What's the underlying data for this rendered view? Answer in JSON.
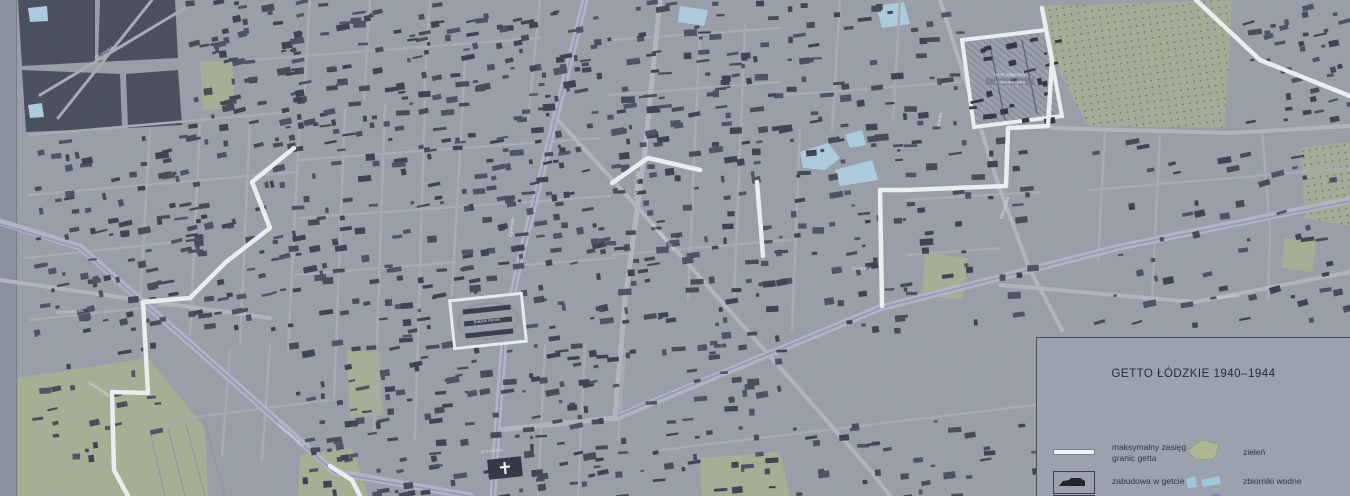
{
  "legend": {
    "title": "GETTO ŁÓDZKIE 1940–1944",
    "items": [
      {
        "swatch": "ghetto-boundary-line",
        "label": "maksymalny zasięg granic getta"
      },
      {
        "swatch": "building-in-ghetto",
        "label": "zabudowa w getcie"
      },
      {
        "swatch": "building-box-cutoff",
        "label": ""
      },
      {
        "swatch": "green-area",
        "label": "zieleń"
      },
      {
        "swatch": "water-body",
        "label": "zbiorniki wodne"
      },
      {
        "swatch": "railway-line",
        "label": "linie kolejowe"
      }
    ]
  },
  "map": {
    "colors": {
      "base": "#9aa0aa",
      "margin": "#8a919d",
      "building": [
        "#3a3f4d",
        "#434854",
        "#4b5060"
      ],
      "dark_block": "#474c5a",
      "road_minor": "#a8adb7",
      "road_major": "#b3b8c2",
      "boundary": "#f3f4f6",
      "green": "#a8b094",
      "cemetery_bg": "#a5ae96",
      "cemetery_dot": "#67755c",
      "water": "#aecfe2",
      "railway": "#998dc4",
      "hatch_line": "#6f7587",
      "label": "#e8eaf0",
      "field_line": "#8f95a0",
      "market_outline": "#eef0f3",
      "cross": "#f5f6f8"
    },
    "labels": [
      {
        "text": "Okopowa",
        "x": 105,
        "y": 54,
        "rot": -35,
        "size": 5
      },
      {
        "text": "Zgierska",
        "x": 513,
        "y": 228,
        "rot": -82,
        "size": 5
      },
      {
        "text": "Łagiewnicka",
        "x": 638,
        "y": 185,
        "rot": -84,
        "size": 5
      },
      {
        "text": "Franciszkańska",
        "x": 662,
        "y": 238,
        "rot": 48,
        "size": 4.6
      },
      {
        "text": "Dworska",
        "x": 862,
        "y": 270,
        "rot": -3,
        "size": 5
      },
      {
        "text": "Bracka",
        "x": 941,
        "y": 120,
        "rot": -80,
        "size": 4.6
      },
      {
        "text": "Marysińska",
        "x": 1006,
        "y": 208,
        "rot": -72,
        "size": 4.6
      },
      {
        "text": "Brzezińska",
        "x": 1228,
        "y": 298,
        "rot": -6,
        "size": 4.6
      },
      {
        "text": "Limanowskiego",
        "x": 290,
        "y": 436,
        "rot": 40,
        "size": 5
      },
      {
        "text": "Lutomierska",
        "x": 98,
        "y": 390,
        "rot": 34,
        "size": 4.8
      },
      {
        "text": "Wrześnieńska",
        "x": 70,
        "y": 313,
        "rot": -4,
        "size": 4.4
      },
      {
        "text": "Bałucki Rynek",
        "x": 487,
        "y": 322,
        "rot": -6,
        "size": 4.2
      },
      {
        "text": "pl. Kościelny",
        "x": 492,
        "y": 452,
        "rot": -4,
        "size": 4.0
      }
    ],
    "hatched_area": {
      "pts": "962,40 1046,30 1062,116 974,127",
      "label_line1": "teren wyłączony",
      "label_line2": "z obszaru getta",
      "lx": 1010,
      "ly": 76
    },
    "greens": [
      "18,378 148,358 205,428 208,496 18,496",
      "347,350 380,352 382,415 350,418",
      "300,455 352,448 368,496 298,496",
      "200,62 232,60 235,108 203,110",
      "925,253 968,258 962,300 922,295",
      "700,458 780,452 790,496 702,496",
      "1284,238 1316,242 1312,272 1282,268"
    ],
    "cemeteries": [
      "1042,6 1232,0 1225,128 1088,126 1054,62",
      "1300,148 1350,142 1350,226 1305,218"
    ],
    "waters": [
      "800,152 828,143 840,158 825,170 803,168",
      "835,170 872,160 878,180 840,186",
      "845,135 862,130 866,145 850,148",
      "876,6 904,2 910,24 882,28",
      "680,6 708,10 704,26 678,22",
      "28,8 47,6 48,21 30,22",
      "28,105 42,103 44,117 30,118"
    ],
    "dark_blocks": [
      "18,0 95,0 95,62 22,66",
      "100,0 175,0 178,58 98,62",
      "22,70 120,74 122,128 26,132",
      "126,74 178,70 182,125 128,128"
    ],
    "roads_major": [
      {
        "pts": "585,0 555,120 520,260 505,330 497,430 493,496",
        "w": 7
      },
      {
        "pts": "0,222 80,247 200,352 335,472 470,496",
        "w": 7
      },
      {
        "pts": "615,418 880,308 1120,247 1350,200",
        "w": 7
      },
      {
        "pts": "660,0 645,150 625,300 615,418",
        "w": 5
      },
      {
        "pts": "497,430 615,418",
        "w": 5
      },
      {
        "pts": "1000,285 1195,302 1350,272",
        "w": 4
      },
      {
        "pts": "556,118 640,210 720,300 800,390 870,470 890,496",
        "w": 4
      },
      {
        "pts": "940,0 975,110 1000,190 1030,270 1062,330",
        "w": 4
      },
      {
        "pts": "1052,128 1230,133 1350,126",
        "w": 4
      },
      {
        "pts": "0,280 140,300 270,318",
        "w": 4
      }
    ],
    "roads_minor": [
      {
        "pts": "58,118 152,0",
        "w": 3
      },
      {
        "pts": "40,95 185,8",
        "w": 3
      },
      {
        "pts": "150,130 140,300",
        "w": 2.5
      },
      {
        "pts": "200,125 190,335",
        "w": 2.5
      },
      {
        "pts": "250,120 240,345",
        "w": 2.5
      },
      {
        "pts": "300,115 288,350",
        "w": 2.5
      },
      {
        "pts": "345,110 334,400",
        "w": 2.5
      },
      {
        "pts": "385,105 374,430",
        "w": 2.5
      },
      {
        "pts": "425,100 415,440",
        "w": 2.5
      },
      {
        "pts": "465,60 452,295",
        "w": 2.5
      },
      {
        "pts": "540,0 528,120",
        "w": 2.5
      },
      {
        "pts": "430,0 424,95",
        "w": 2.5
      },
      {
        "pts": "370,0 364,100",
        "w": 2.5
      },
      {
        "pts": "310,0 304,98",
        "w": 2.5
      },
      {
        "pts": "700,30 688,300",
        "w": 2.5
      },
      {
        "pts": "745,25 734,300",
        "w": 2.5
      },
      {
        "pts": "800,130 792,330",
        "w": 2.5
      },
      {
        "pts": "840,0 832,130",
        "w": 2.5
      },
      {
        "pts": "900,0 893,120",
        "w": 2.5
      },
      {
        "pts": "1105,132 1098,260",
        "w": 2.5
      },
      {
        "pts": "1160,135 1152,300",
        "w": 2.5
      },
      {
        "pts": "1262,130 1270,230 1268,300",
        "w": 2.5
      },
      {
        "pts": "30,135 290,112",
        "w": 2.5
      },
      {
        "pts": "28,195 295,172",
        "w": 2.5
      },
      {
        "pts": "25,258 195,240",
        "w": 2.5
      },
      {
        "pts": "300,160 600,138",
        "w": 2.5
      },
      {
        "pts": "300,218 610,196",
        "w": 2.5
      },
      {
        "pts": "295,275 455,262",
        "w": 2.5
      },
      {
        "pts": "525,265 615,258",
        "w": 2.5
      },
      {
        "pts": "610,95 780,82",
        "w": 2.5
      },
      {
        "pts": "612,255 790,240",
        "w": 2.5
      },
      {
        "pts": "785,95 960,82",
        "w": 2.5
      },
      {
        "pts": "905,200 1040,192",
        "w": 2.5
      },
      {
        "pts": "908,255 1000,248",
        "w": 2.5
      },
      {
        "pts": "1090,190 1350,168",
        "w": 2.5
      },
      {
        "pts": "250,60 540,38",
        "w": 2.5
      },
      {
        "pts": "610,40 780,28",
        "w": 2.5
      },
      {
        "pts": "30,320 170,305",
        "w": 2.5
      },
      {
        "pts": "660,450 1035,405",
        "w": 2.5
      },
      {
        "pts": "545,345 538,496",
        "w": 2.5
      },
      {
        "pts": "585,345 578,496",
        "w": 2.5
      },
      {
        "pts": "625,350 618,440",
        "w": 2.5
      },
      {
        "pts": "230,350 222,455",
        "w": 2.5
      },
      {
        "pts": "270,345 262,460",
        "w": 2.5
      },
      {
        "pts": "170,420 330,400",
        "w": 2
      }
    ],
    "field_lines": [
      "150,432 165,496",
      "168,428 185,496",
      "186,424 205,496",
      "204,420 225,496"
    ],
    "railways": [
      "585,0 555,120 520,260 505,330 497,430 493,496",
      "0,224 80,248 200,352 335,473 470,496",
      "617,416 880,308 1120,247 1350,201"
    ],
    "boundary_segments": [
      "294,148 252,182 270,228 226,262 190,298 143,302 148,393 112,392 114,470 128,496",
      "330,466 352,480 360,496",
      "612,183 648,158 700,170",
      "757,182 763,256",
      "882,306 880,190 906,190 1006,186 1008,128 1048,126",
      "1048,126 1052,60 1042,8",
      "1196,0 1260,60 1350,96"
    ],
    "building_zones": [
      {
        "x": 185,
        "y": 0,
        "w": 115,
        "h": 130,
        "n": 60,
        "a": -10
      },
      {
        "x": 30,
        "y": 135,
        "w": 250,
        "h": 200,
        "n": 150,
        "a": -10
      },
      {
        "x": 285,
        "y": 0,
        "w": 315,
        "h": 150,
        "n": 160,
        "a": -8
      },
      {
        "x": 285,
        "y": 150,
        "w": 315,
        "h": 250,
        "n": 220,
        "a": -8
      },
      {
        "x": 300,
        "y": 400,
        "w": 300,
        "h": 96,
        "n": 90,
        "a": -8
      },
      {
        "x": 605,
        "y": 0,
        "w": 175,
        "h": 200,
        "n": 100,
        "a": -6
      },
      {
        "x": 605,
        "y": 200,
        "w": 175,
        "h": 210,
        "n": 90,
        "a": -6
      },
      {
        "x": 785,
        "y": 0,
        "w": 175,
        "h": 150,
        "n": 60,
        "a": -5
      },
      {
        "x": 785,
        "y": 150,
        "w": 120,
        "h": 180,
        "n": 40,
        "a": -5
      },
      {
        "x": 905,
        "y": 130,
        "w": 130,
        "h": 190,
        "n": 35,
        "a": -5
      },
      {
        "x": 1085,
        "y": 140,
        "w": 265,
        "h": 185,
        "n": 55,
        "a": -12
      },
      {
        "x": 1235,
        "y": 0,
        "w": 115,
        "h": 125,
        "n": 38,
        "a": -12
      },
      {
        "x": 605,
        "y": 415,
        "w": 430,
        "h": 81,
        "n": 60,
        "a": -6
      },
      {
        "x": 30,
        "y": 340,
        "w": 130,
        "h": 120,
        "n": 25,
        "a": -8
      }
    ],
    "hatch_buildings": {
      "x": 968,
      "y": 38,
      "w": 88,
      "h": 84,
      "n": 22,
      "a": -10
    },
    "market": {
      "x": 452,
      "y": 297,
      "w": 72,
      "h": 48,
      "rot": -6
    },
    "church": {
      "x": 488,
      "y": 458,
      "w": 34,
      "h": 20,
      "rot": -6,
      "cx": 505,
      "cy": 468
    }
  }
}
